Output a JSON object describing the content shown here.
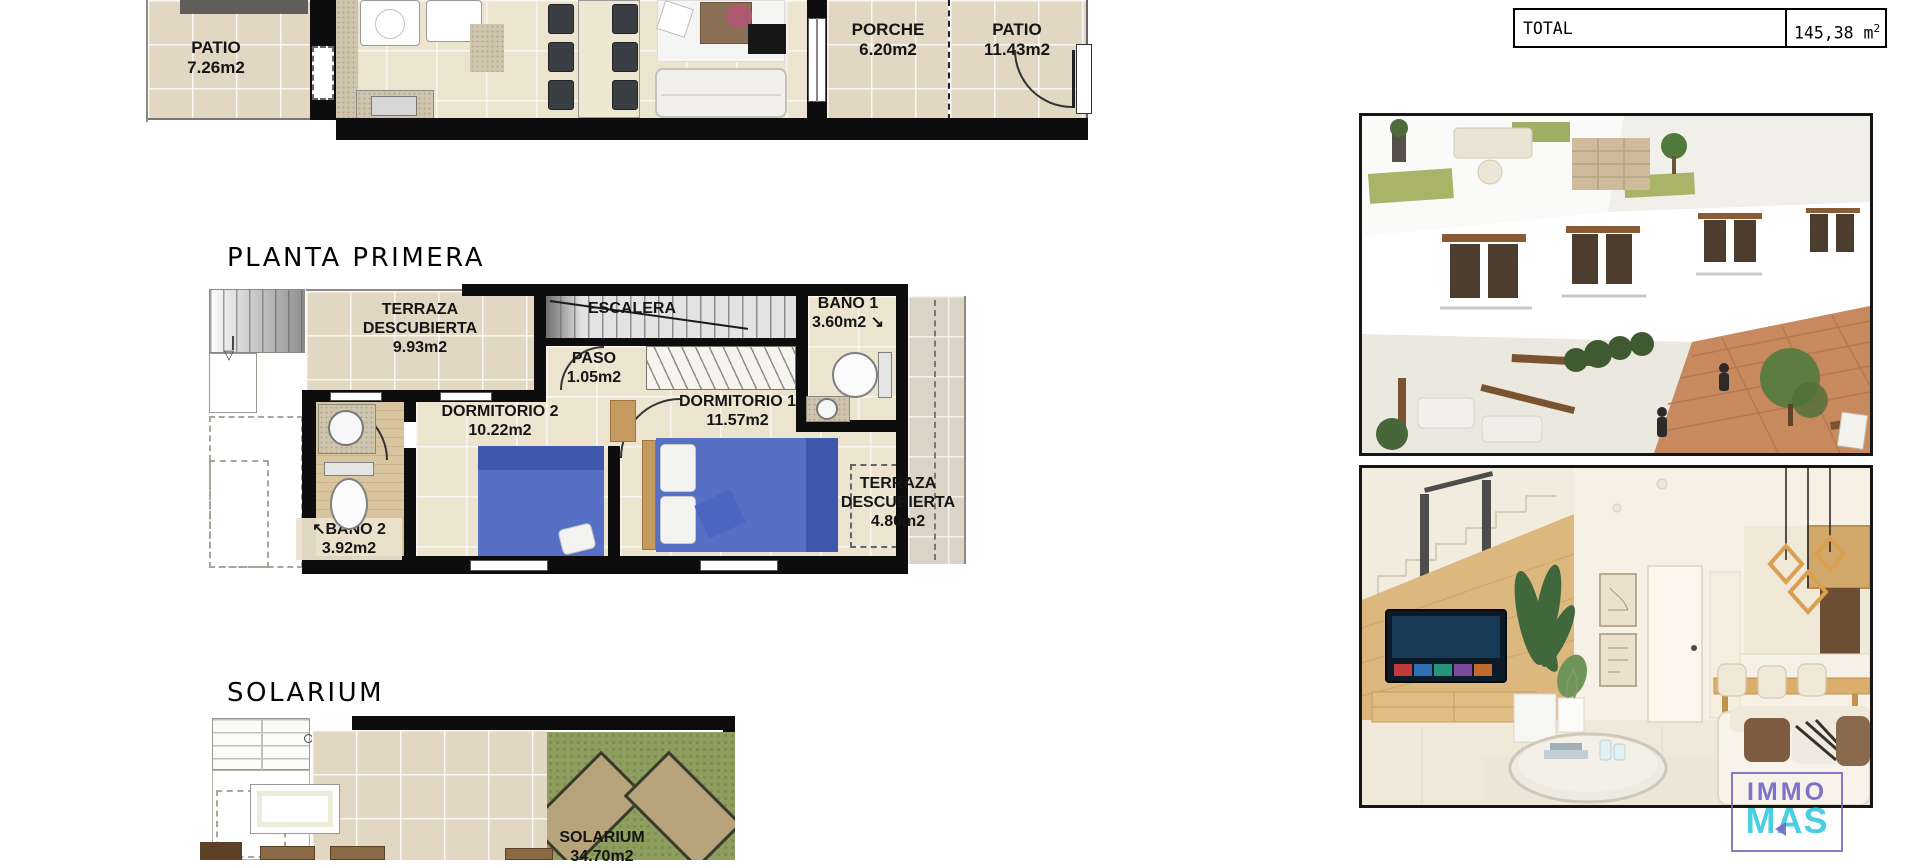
{
  "titles": {
    "first_floor": "PLANTA PRIMERA",
    "solarium": "SOLARIUM"
  },
  "total_table": {
    "label": "TOTAL",
    "value": "145,38",
    "unit": "m",
    "exp": "2"
  },
  "rooms": {
    "patio_left": {
      "name": "PATIO",
      "area": "7.26m2"
    },
    "porche": {
      "name": "PORCHE",
      "area": "6.20m2"
    },
    "patio_right": {
      "name": "PATIO",
      "area": "11.43m2"
    },
    "terraza_top": {
      "name1": "TERRAZA",
      "name2": "DESCUBIERTA",
      "area": "9.93m2"
    },
    "escalera": {
      "name": "ESCALERA"
    },
    "bano1": {
      "name": "BAÑO 1",
      "area": "3.60m2"
    },
    "paso": {
      "name": "PASO",
      "area": "1.05m2"
    },
    "dorm2": {
      "name": "DORMITORIO 2",
      "area": "10.22m2"
    },
    "dorm1": {
      "name": "DORMITORIO 1",
      "area": "11.57m2"
    },
    "bano2": {
      "name": "BAÑO 2",
      "area": "3.92m2"
    },
    "terraza_right": {
      "name1": "TERRAZA",
      "name2": "DESCUBIERTA",
      "area": "4.80m2"
    },
    "solarium": {
      "name": "SOLARIUM",
      "area": "34.70m2"
    }
  },
  "icons": {
    "bano1_door_arrow": "↘",
    "bano2_door_arrow": "↖",
    "stair_down_arrow": "▽"
  },
  "logo": {
    "line1": "IMMO",
    "line2": "MAS"
  },
  "photos": {
    "exterior_name": "exterior-render",
    "interior_name": "interior-render"
  },
  "colors": {
    "wall_black": "#0d0d0d",
    "tile_beige": "#e1d7c3",
    "bed_blue": "#5770c5",
    "bed_blue_dark": "#3f58ab",
    "grass_green": "#8d9e5e",
    "wood_tan": "#c59a60",
    "brick_plaza": "#c8895e",
    "logo_purple": "#7668c4",
    "logo_cyan": "#3fccdf"
  }
}
